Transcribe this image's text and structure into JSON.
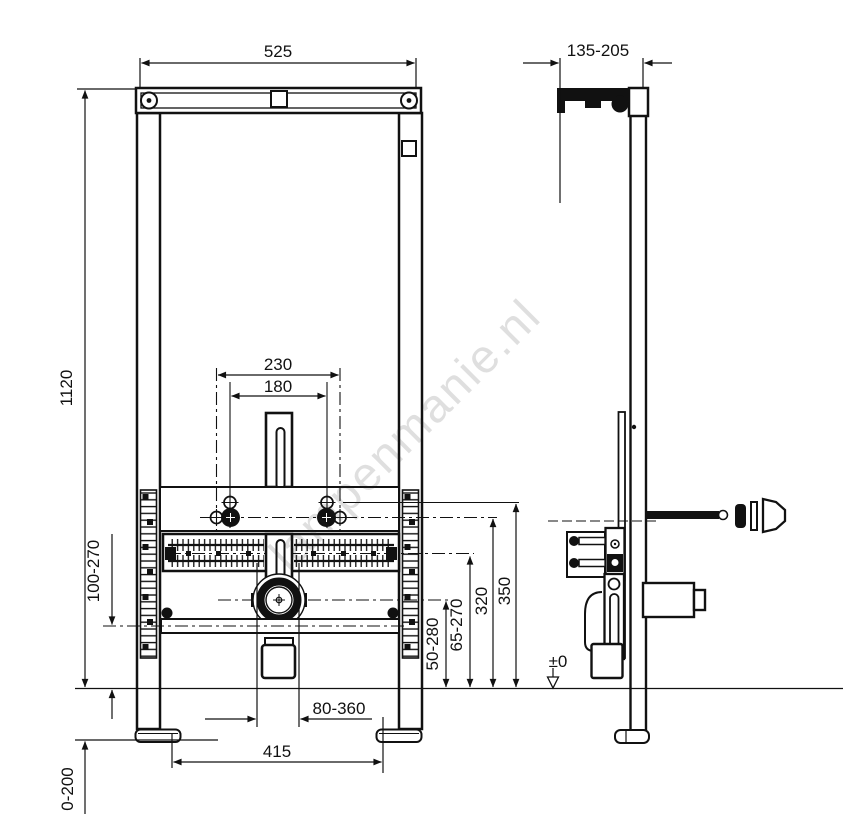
{
  "watermark": {
    "text": "lampenmanie.nl"
  },
  "front_view": {
    "width_top": "525",
    "height_total": "1120",
    "holes_outer": "230",
    "holes_inner": "180",
    "lower_bar_height": "100-270",
    "foot_adjust": "0-200",
    "feet_spacing": "415",
    "drain_offset": "80-360",
    "h_top_holes": "350",
    "h_fix_holes": "320",
    "h_rack": "65-270",
    "h_drain": "50-280"
  },
  "side_view": {
    "depth": "135-205",
    "floor_level": "±0"
  }
}
